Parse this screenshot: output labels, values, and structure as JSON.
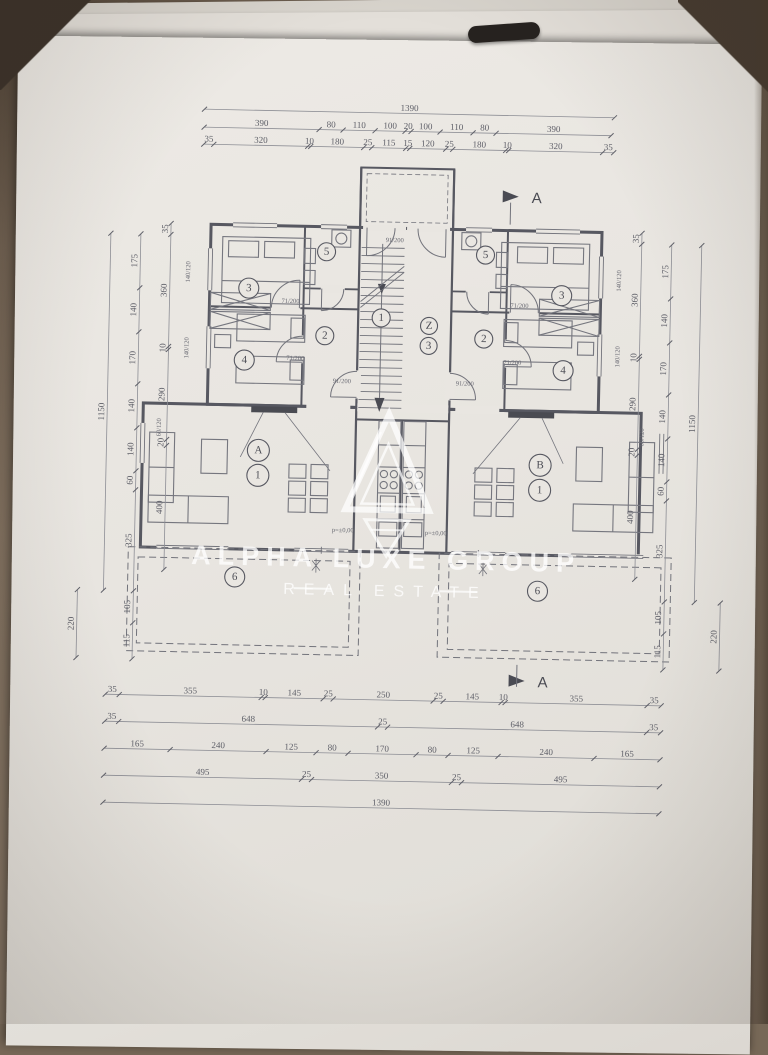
{
  "watermark": {
    "title": "ALPHA LUXE GROUP",
    "subtitle": "REAL ESTATE"
  },
  "section_marker": {
    "label": "A"
  },
  "dims": {
    "top": {
      "row1": [
        "1390"
      ],
      "row2": [
        "390",
        "80",
        "110",
        "100",
        "20",
        "100",
        "110",
        "80",
        "390"
      ],
      "row3": [
        "35",
        "320",
        "10",
        "180",
        "25",
        "115",
        "15",
        "120",
        "25",
        "180",
        "10",
        "320",
        "35"
      ]
    },
    "bottom": {
      "row1": [
        "35",
        "355",
        "10",
        "145",
        "25",
        "250",
        "25",
        "145",
        "10",
        "355",
        "35"
      ],
      "row2": [
        "35",
        "648",
        "25",
        "648",
        "35"
      ],
      "row3": [
        "165",
        "240",
        "125",
        "80",
        "170",
        "80",
        "125",
        "240",
        "165"
      ],
      "row4": [
        "495",
        "25",
        "350",
        "25",
        "495"
      ],
      "row5": [
        "1390"
      ]
    },
    "left": {
      "inner": [
        "35",
        "360",
        "10",
        "290",
        "20",
        "400"
      ],
      "middle": [
        "175",
        "140",
        "170",
        "140",
        "140",
        "60",
        "325",
        "105",
        "115"
      ],
      "outer": [
        "1150"
      ],
      "terrace": [
        "220"
      ]
    },
    "right": {
      "inner": [
        "35",
        "360",
        "10",
        "290",
        "20",
        "400"
      ],
      "middle": [
        "175",
        "140",
        "170",
        "140",
        "140",
        "60",
        "325",
        "105",
        "115"
      ],
      "outer": [
        "1150"
      ],
      "terrace": [
        "220"
      ]
    }
  },
  "rooms": {
    "bedroom_large": "3",
    "bathroom": "5",
    "hall": "2",
    "bedroom_small": "4",
    "stair_flight": "1",
    "core_letter": "Z",
    "core_number": "3",
    "apartment_a": "A",
    "apartment_b": "B",
    "living": "1",
    "terrace": "6"
  },
  "notes": {
    "door_71": "71/200",
    "door_91": "91/200",
    "window_140": "140/120",
    "window_60": "60/120",
    "level": "p=±0,00"
  }
}
